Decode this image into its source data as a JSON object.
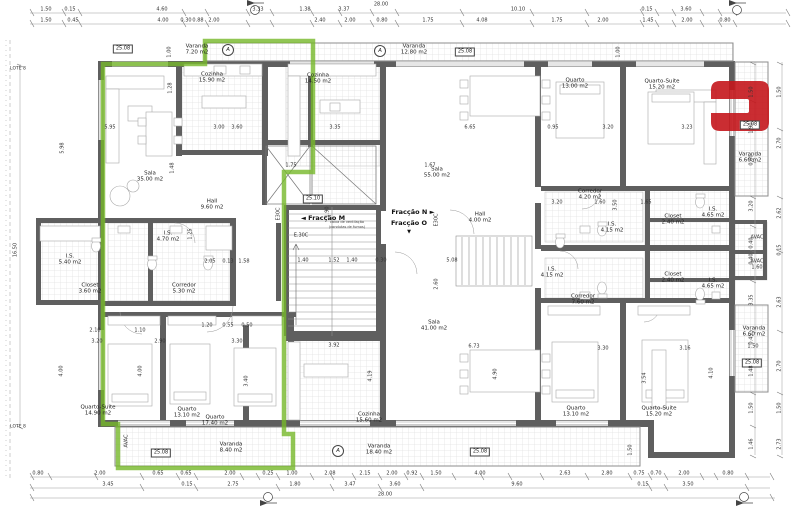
{
  "colors": {
    "highlight_green": "#76b829",
    "logo_red": "#c4161c",
    "wall_gray": "#5f5f5f"
  },
  "lote": "LOTE 8",
  "fraccao": {
    "m": "◄ Fracção M",
    "n": "Fracção N ►",
    "o": "Fracção O",
    "o_arrow": "▼"
  },
  "tech": {
    "letter_a": "A",
    "e30c": "E30C",
    "e30c2": "E.30C",
    "avac": "AVAC",
    "avac_val": "1.60",
    "vent_l1": "caixa de ventilação",
    "vent_l2": "(condutas de fumos)"
  },
  "boxes": {
    "b2508": "25.08",
    "b2510": "25.10",
    "v150": "1.50"
  },
  "rooms": [
    {
      "name": "Varanda",
      "area": "7.20 m2"
    },
    {
      "name": "Cozinha",
      "area": "15.90 m2"
    },
    {
      "name": "Sala",
      "area": "35.00 m2"
    },
    {
      "name": "Hall",
      "area": "9.60 m2"
    },
    {
      "name": "I.S.",
      "area": "4.70 m2"
    },
    {
      "name": "I.S.",
      "area": "5.40 m2"
    },
    {
      "name": "Closet",
      "area": "3.60 m2"
    },
    {
      "name": "Corredor",
      "area": "5.30 m2"
    },
    {
      "name": "Quarto-Suite",
      "area": "14.90 m2"
    },
    {
      "name": "Quarto",
      "area": "13.10 m2"
    },
    {
      "name": "Quarto",
      "area": "17.40 m2"
    },
    {
      "name": "Varanda",
      "area": "8.40 m2"
    },
    {
      "name": "Varanda",
      "area": "12.80 m2"
    },
    {
      "name": "Cozinha",
      "area": "14.50 m2"
    },
    {
      "name": "Sala",
      "area": "55.00 m2"
    },
    {
      "name": "Quarto",
      "area": "13.00 m2"
    },
    {
      "name": "Quarto-Suite",
      "area": "15.20 m2"
    },
    {
      "name": "Varanda",
      "area": "6.60 m2"
    },
    {
      "name": "Corredor",
      "area": "4.20 m2"
    },
    {
      "name": "I.S.",
      "area": "4.15 m2"
    },
    {
      "name": "Closet",
      "area": "2.40 m2"
    },
    {
      "name": "I.S.",
      "area": "4.65 m2"
    },
    {
      "name": "Hall",
      "area": "4.00 m2"
    },
    {
      "name": "I.S.",
      "area": "4.15 m2"
    },
    {
      "name": "Corredor",
      "area": "7.60 m2"
    },
    {
      "name": "Closet",
      "area": "2.40 m2"
    },
    {
      "name": "I.S.",
      "area": "4.65 m2"
    },
    {
      "name": "Sala",
      "area": "41.00 m2"
    },
    {
      "name": "Cozinha",
      "area": "15.60 m2"
    },
    {
      "name": "Varanda",
      "area": "18.40 m2"
    },
    {
      "name": "Quarto",
      "area": "13.10 m2"
    },
    {
      "name": "Quarto-Suite",
      "area": "15.20 m2"
    },
    {
      "name": "Varanda",
      "area": "6.60 m2"
    }
  ],
  "dims": {
    "top_total": "28.00",
    "bottom_total": "28.00",
    "top1": [
      "1.50",
      "0.15",
      "4.60",
      "3.33",
      "1.38",
      "3.37",
      "10.10",
      "0.15",
      "3.60"
    ],
    "top2": [
      "1.50",
      "0.45",
      "4.00",
      "0.30",
      "0.88",
      "2.00",
      "2.40",
      "2.00",
      "0.80",
      "1.75",
      "4.08",
      "1.75",
      "2.00",
      "1.45",
      "2.00",
      "0.80"
    ],
    "bottom1": [
      "0.80",
      "2.00",
      "0.65",
      "0.65",
      "2.00",
      "0.25",
      "1.00",
      "2.08",
      "2.15",
      "2.00",
      "0.92",
      "1.50",
      "4.00",
      "2.63",
      "2.80",
      "0.75",
      "0.70",
      "2.00",
      "0.80"
    ],
    "bottom2": [
      "3.45",
      "0.15",
      "2.75",
      "1.80",
      "3.47",
      "3.60",
      "9.60",
      "0.15",
      "3.50"
    ],
    "left": [
      "16.50"
    ],
    "right": [
      "1.50",
      "1.50",
      "1.90",
      "2.70",
      "0.60",
      "3.20",
      "2.62",
      "0.40",
      "0.15",
      "0.40",
      "3.35",
      "2.63",
      "0.45",
      "1.48",
      "2.70",
      "1.50",
      "1.50",
      "1.46",
      "2.73"
    ],
    "inner": [
      "1.00",
      "1.28",
      "5.95",
      "3.00",
      "3.60",
      "5.98",
      "1.48",
      "1.25",
      "2.05",
      "0.13",
      "1.58",
      "2.10",
      "1.10",
      "1.20",
      "0.55",
      "0.50",
      "1.40",
      "1.52",
      "1.40",
      "0.30",
      "1.90",
      "5.08",
      "2.60",
      "1.75",
      "3.35",
      "6.65",
      "1.67",
      "0.95",
      "3.20",
      "3.23",
      "1.00",
      "3.50",
      "3.20",
      "1.60",
      "1.65",
      "6.73",
      "3.92",
      "4.19",
      "4.90",
      "3.20",
      "2.90",
      "3.30",
      "4.00",
      "4.00",
      "3.40",
      "3.30",
      "3.16",
      "3.54",
      "4.10",
      "1.50"
    ]
  }
}
